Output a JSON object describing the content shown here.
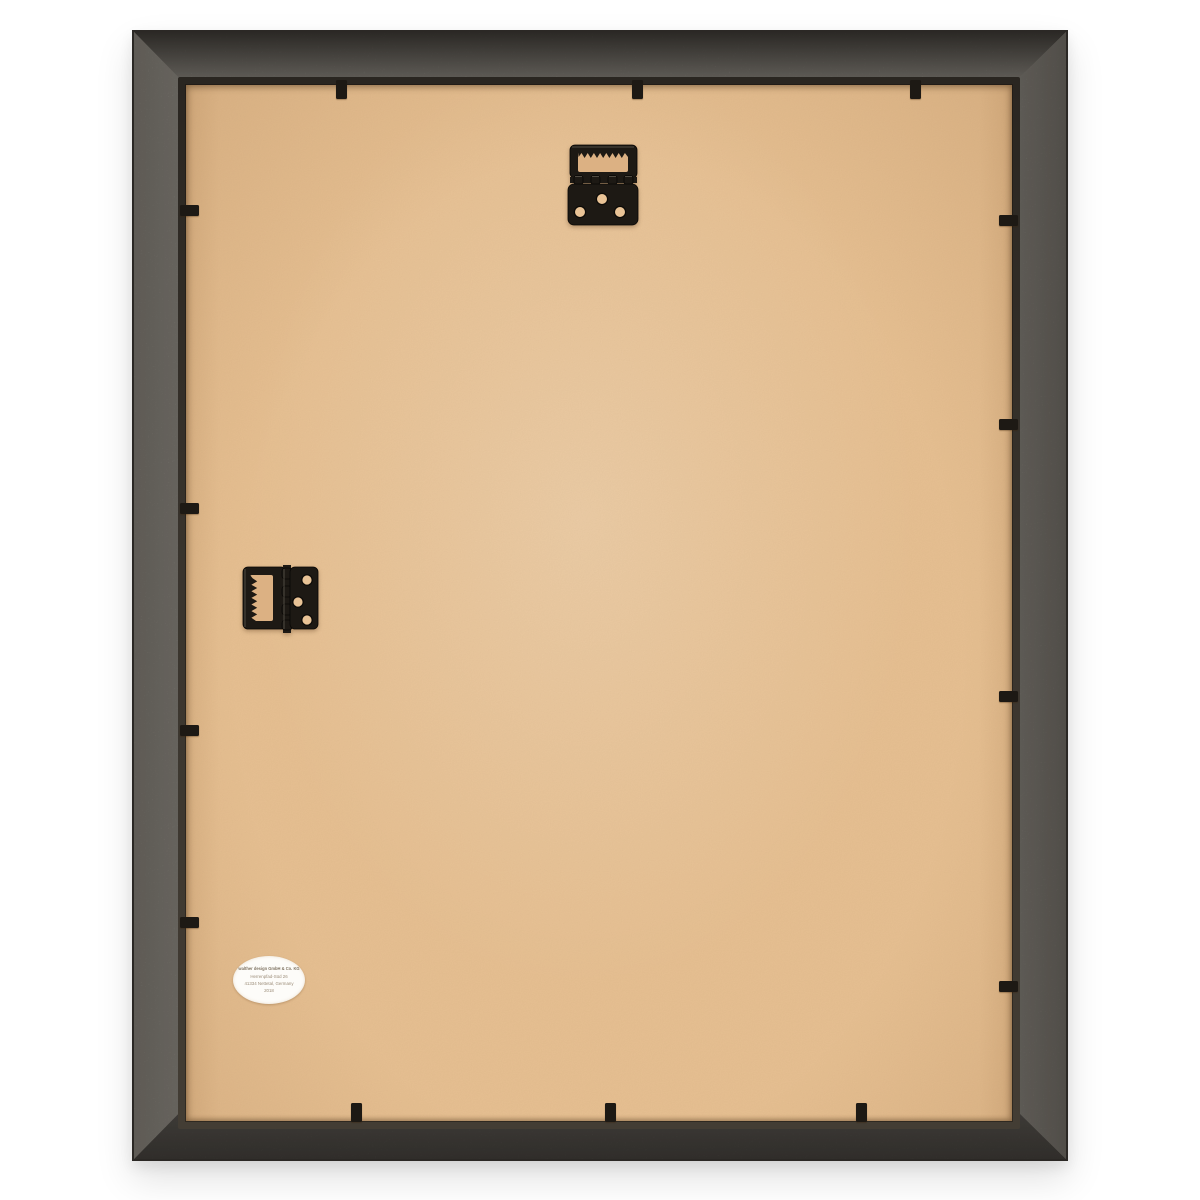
{
  "scene": {
    "subject": "Rear view of an empty picture frame: grey moulding, kraft MDF backing board, two sawtooth hinge hangers and black flexi clips around the edges"
  },
  "sticker": {
    "lines": [
      "walther design GmbH & Co. KG",
      "Herrenpfad-Süd 26",
      "41334 Nettetal, Germany",
      "2018"
    ]
  },
  "hardware": {
    "top_hanger_icon": "sawtooth-hinge-hanger-icon",
    "side_hanger_icon": "sawtooth-hinge-hanger-rotated-icon",
    "clips": {
      "top": [
        341,
        637,
        915
      ],
      "bottom": [
        356,
        610,
        861
      ],
      "left": [
        210,
        508,
        730,
        922
      ],
      "right": [
        220,
        424,
        696,
        986
      ]
    }
  },
  "colors": {
    "background": "#ffffff",
    "frame_grey": "#7e7a73",
    "frame_outline": "#2b2825",
    "lip": "#3a352e",
    "backing": "#e9c294",
    "hardware": "#1d1914",
    "sticker_bg": "#fdfcf9",
    "sticker_text": "#9c8d79"
  }
}
